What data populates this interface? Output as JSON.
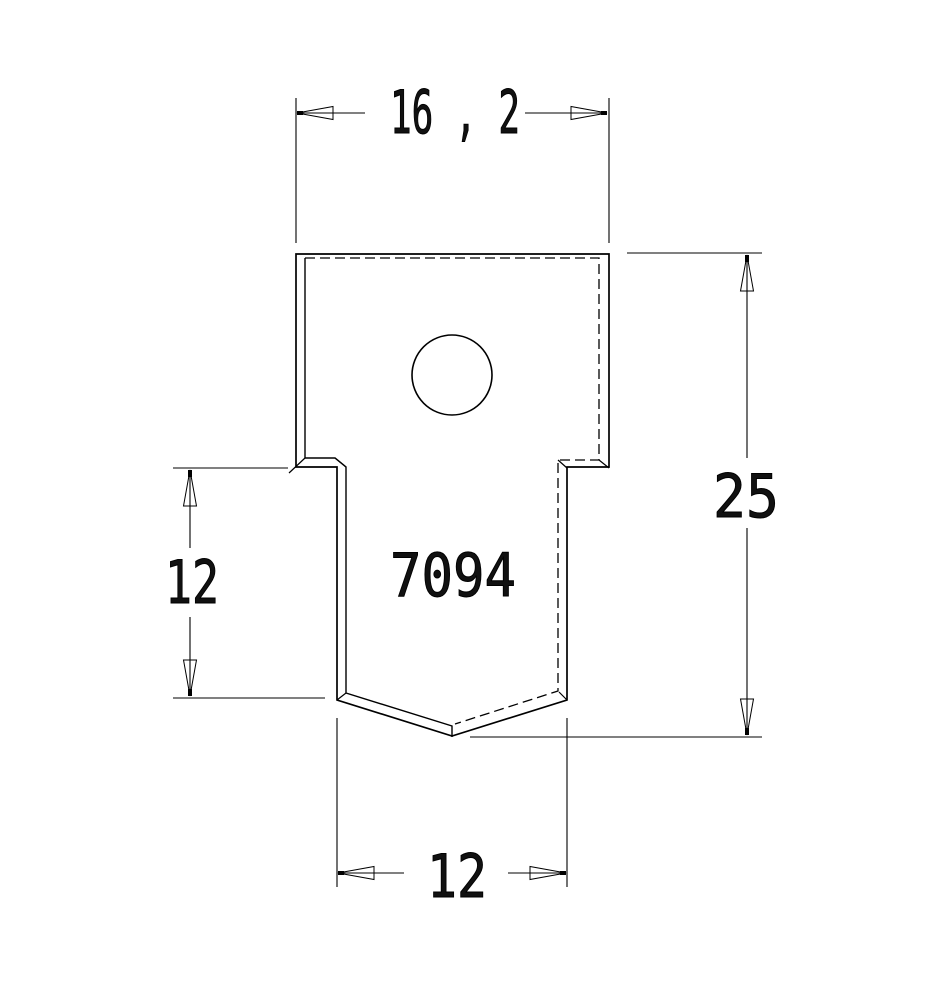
{
  "drawing": {
    "part_number": "7094",
    "dimensions": {
      "top_width": "16 , 2",
      "overall_height": "25",
      "tab_length": "12",
      "tab_width": "12"
    },
    "colors": {
      "line": "#000000",
      "background": "#ffffff"
    }
  }
}
